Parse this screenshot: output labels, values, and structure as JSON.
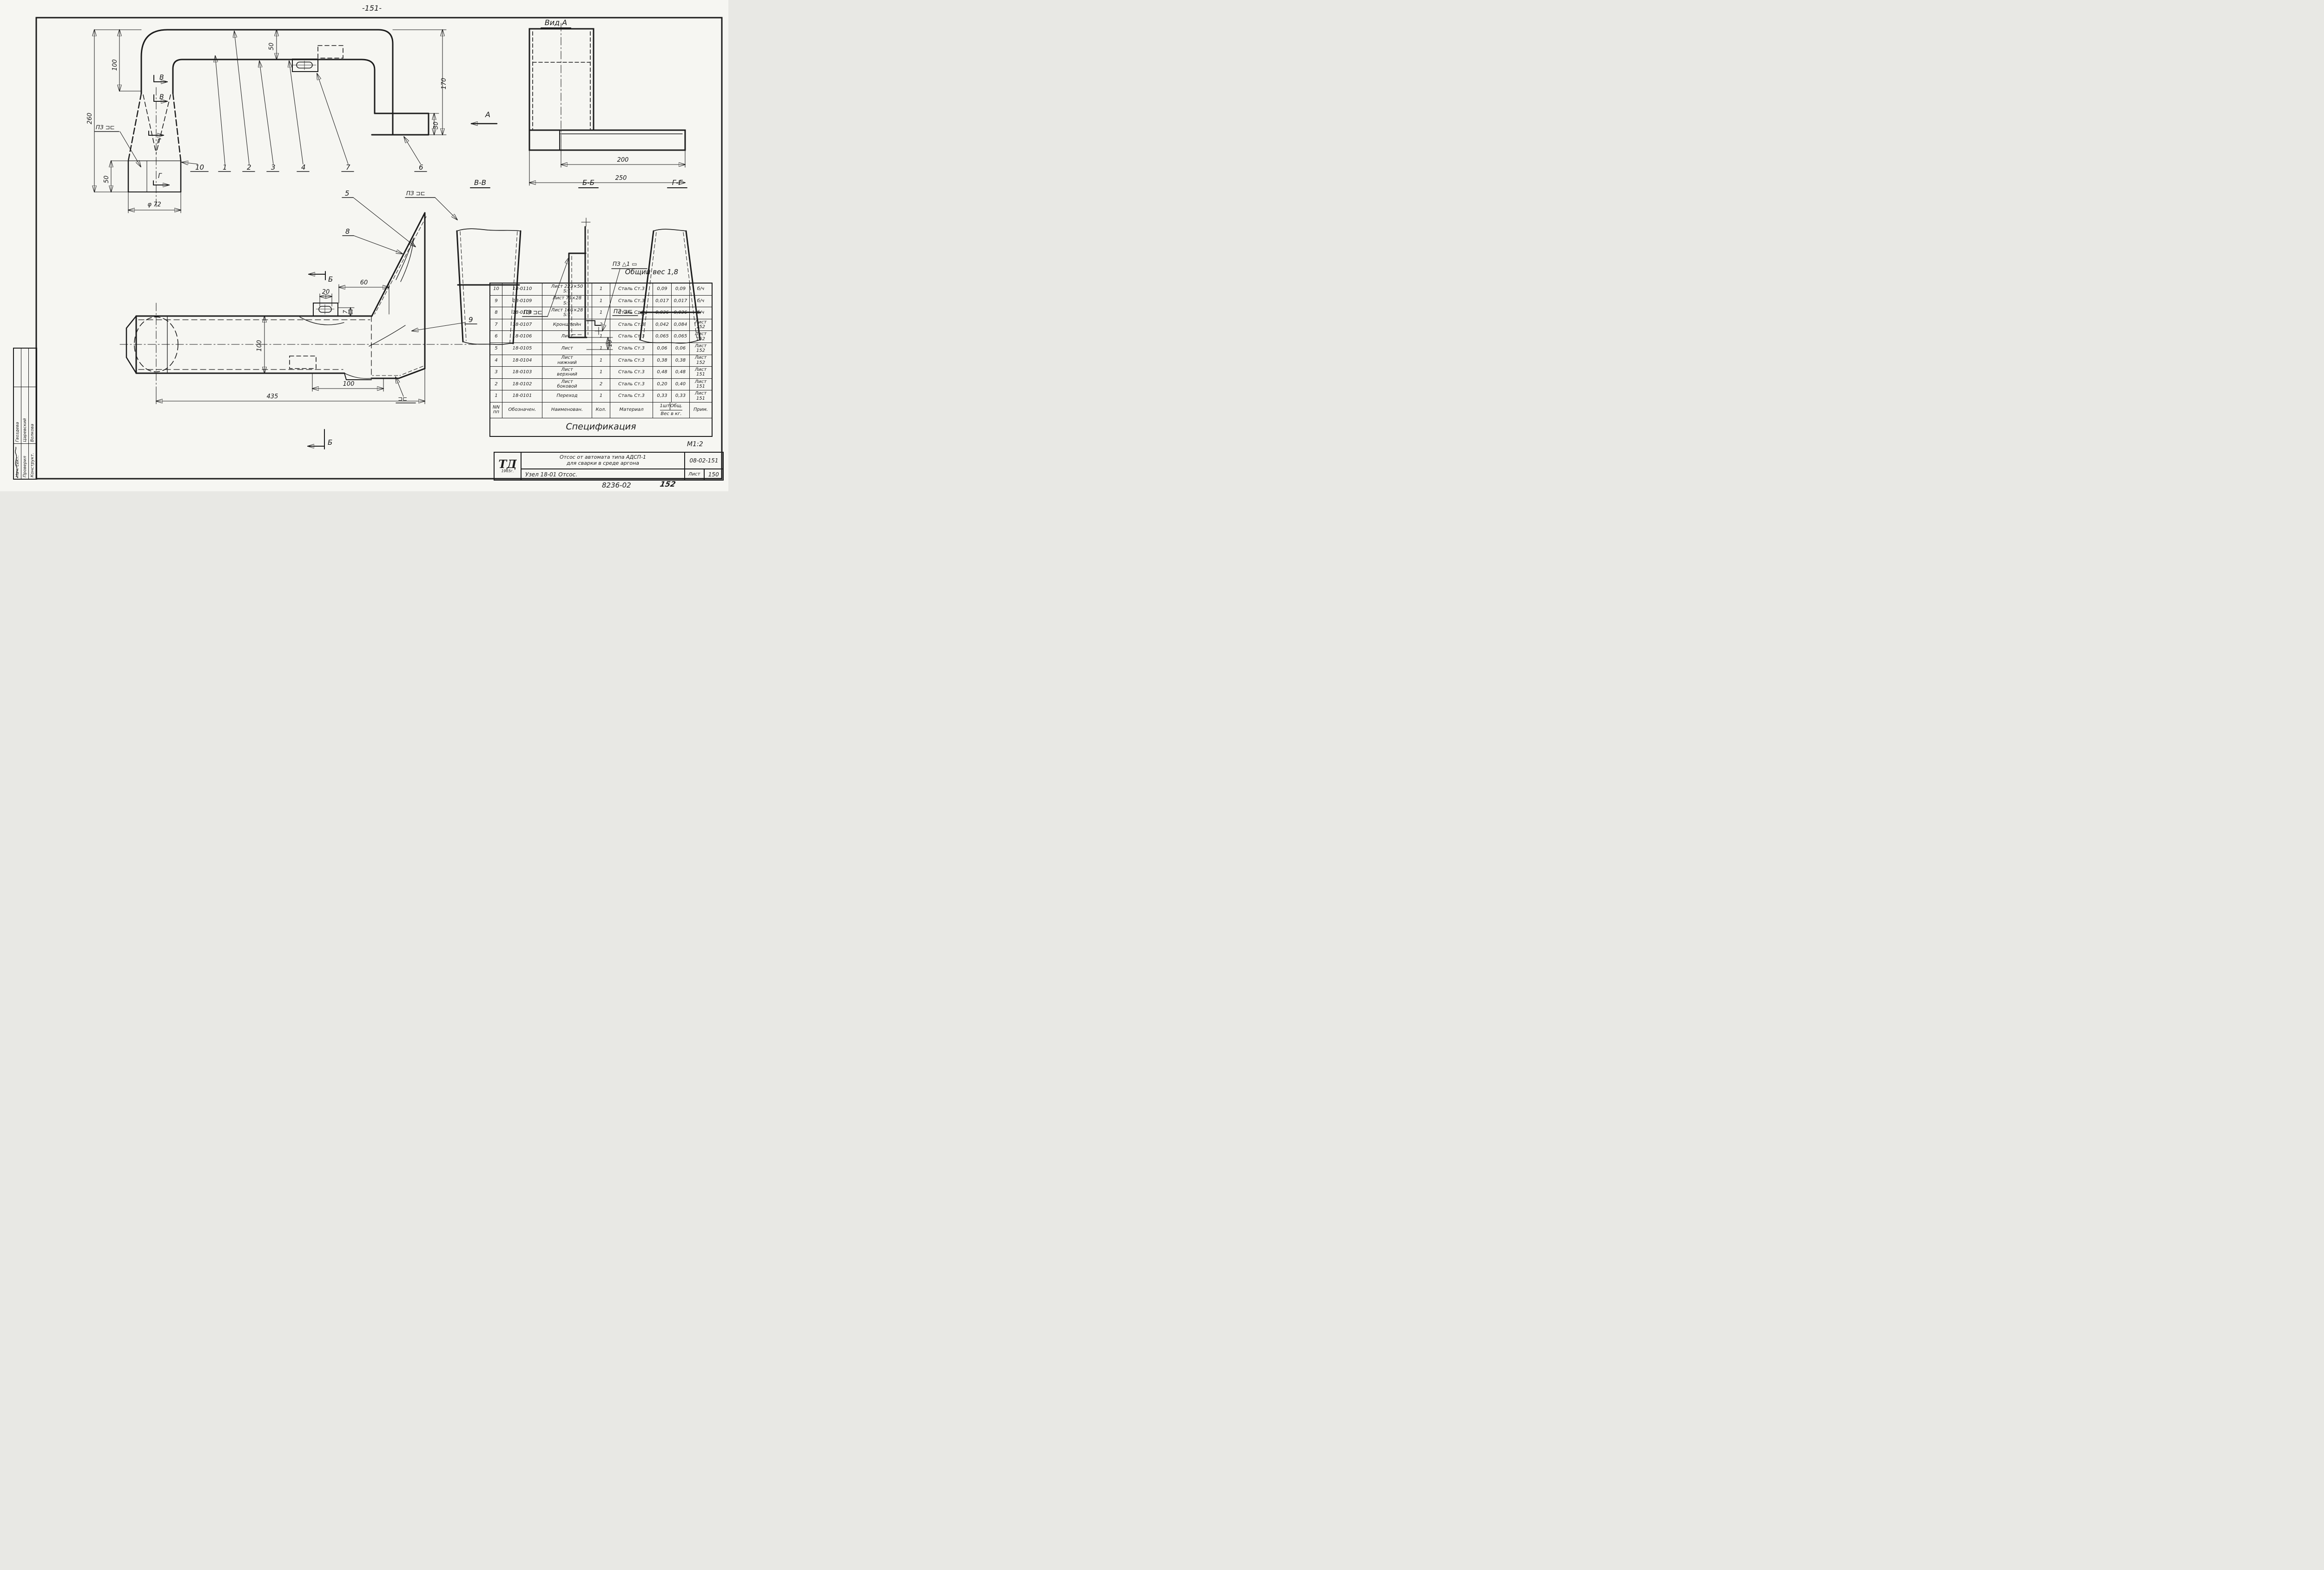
{
  "page": {
    "number": "-151-",
    "scale": "М1:2",
    "code_bottom": "8236-02",
    "sheet_bottom": "152"
  },
  "labels": {
    "vid_a": "Вид А",
    "sec_vv": "В-В",
    "sec_bb": "Б-Б",
    "sec_gg": "Г-Г",
    "arrow_a": "А",
    "arrow_b": "Б",
    "arrow_v": "В",
    "arrow_g": "Г",
    "total_weight": "Общий вес 1,8",
    "weld_pz": "ПЗ ⊐⊏",
    "weld_pz_short": "⊐⊏",
    "weld_pz_triangle": "ПЗ △1 ▭"
  },
  "dims": {
    "h260": "260",
    "h100": "100",
    "h50_funnel": "50",
    "dia72": "φ 72",
    "t50": "50",
    "h170": "170",
    "h30": "30",
    "w200": "200",
    "w250": "250",
    "w60": "60",
    "w20": "20",
    "t7": "7",
    "h100_duct": "100",
    "w100": "100",
    "w435": "435",
    "t10": "10"
  },
  "callouts": {
    "c1": "1",
    "c2": "2",
    "c3": "3",
    "c4": "4",
    "c5": "5",
    "c6": "6",
    "c7": "7",
    "c8": "8",
    "c9": "9",
    "c10": "10"
  },
  "spec": {
    "title": "Спецификация",
    "header": {
      "num": "NN\nпп",
      "designation": "Обозначен.",
      "name": "Наименован.",
      "qty": "Кол.",
      "material": "Материал",
      "weight_each": "1шт",
      "weight_total": "Общ.",
      "weight_label": "Вес в кг.",
      "note": "Прим."
    },
    "rows": [
      {
        "num": "10",
        "designation": "18-0110",
        "name": "Лист 223×50\nS:1",
        "qty": "1",
        "material": "Сталь Ст.3",
        "weight_each": "0,09",
        "weight_total": "0,09",
        "note": "б/ч"
      },
      {
        "num": "9",
        "designation": "18-0109",
        "name": "Лист 79×28\nS:1",
        "qty": "1",
        "material": "Сталь Ст.3",
        "weight_each": "0,017",
        "weight_total": "0,017",
        "note": "б/ч"
      },
      {
        "num": "8",
        "designation": "18-0108",
        "name": "Лист 166×28\nS:1",
        "qty": "1",
        "material": "Сталь Ст.3",
        "weight_each": "0,036",
        "weight_total": "0,036",
        "note": "б/ч"
      },
      {
        "num": "7",
        "designation": "18-0107",
        "name": "Кронштейн",
        "qty": "2",
        "material": "Сталь Ст.3",
        "weight_each": "0,042",
        "weight_total": "0,084",
        "note": "Лист 152"
      },
      {
        "num": "6",
        "designation": "18-0106",
        "name": "Лист",
        "qty": "1",
        "material": "Сталь Ст.3",
        "weight_each": "0,065",
        "weight_total": "0,065",
        "note": "Лист 152"
      },
      {
        "num": "5",
        "designation": "18-0105",
        "name": "Лист",
        "qty": "1",
        "material": "Сталь Ст.3",
        "weight_each": "0,06",
        "weight_total": "0,06",
        "note": "Лист 152"
      },
      {
        "num": "4",
        "designation": "18-0104",
        "name": "Лист\nнижний",
        "qty": "1",
        "material": "Сталь Ст.3",
        "weight_each": "0,38",
        "weight_total": "0,38",
        "note": "Лист 152"
      },
      {
        "num": "3",
        "designation": "18-0103",
        "name": "Лист\nверхний",
        "qty": "1",
        "material": "Сталь Ст.3",
        "weight_each": "0,48",
        "weight_total": "0,48",
        "note": "Лист 151"
      },
      {
        "num": "2",
        "designation": "18-0102",
        "name": "Лист\nбоковой",
        "qty": "2",
        "material": "Сталь Ст.3",
        "weight_each": "0,20",
        "weight_total": "0,40",
        "note": "Лист 151"
      },
      {
        "num": "1",
        "designation": "18-0101",
        "name": "Переход",
        "qty": "1",
        "material": "Сталь Ст.3",
        "weight_each": "0,33",
        "weight_total": "0,33",
        "note": "Лист 151"
      }
    ]
  },
  "title_block": {
    "logo": "ТД",
    "year": "1965г.",
    "title_line1": "Отсос от автомата типа АДСП-1",
    "title_line2": "для сварки в среде аргона",
    "doc_number": "08-02-151",
    "node_line": "Узел 18-01    Отсос.",
    "sheet_label": "Лист",
    "sheet_number": "150"
  },
  "stamp": {
    "rows": [
      {
        "label": "Нач. сект.",
        "name": "Гвоздева"
      },
      {
        "label": "Проверил",
        "name": "Царевский"
      },
      {
        "label": "Конструкт.",
        "name": "Волкова"
      }
    ]
  }
}
